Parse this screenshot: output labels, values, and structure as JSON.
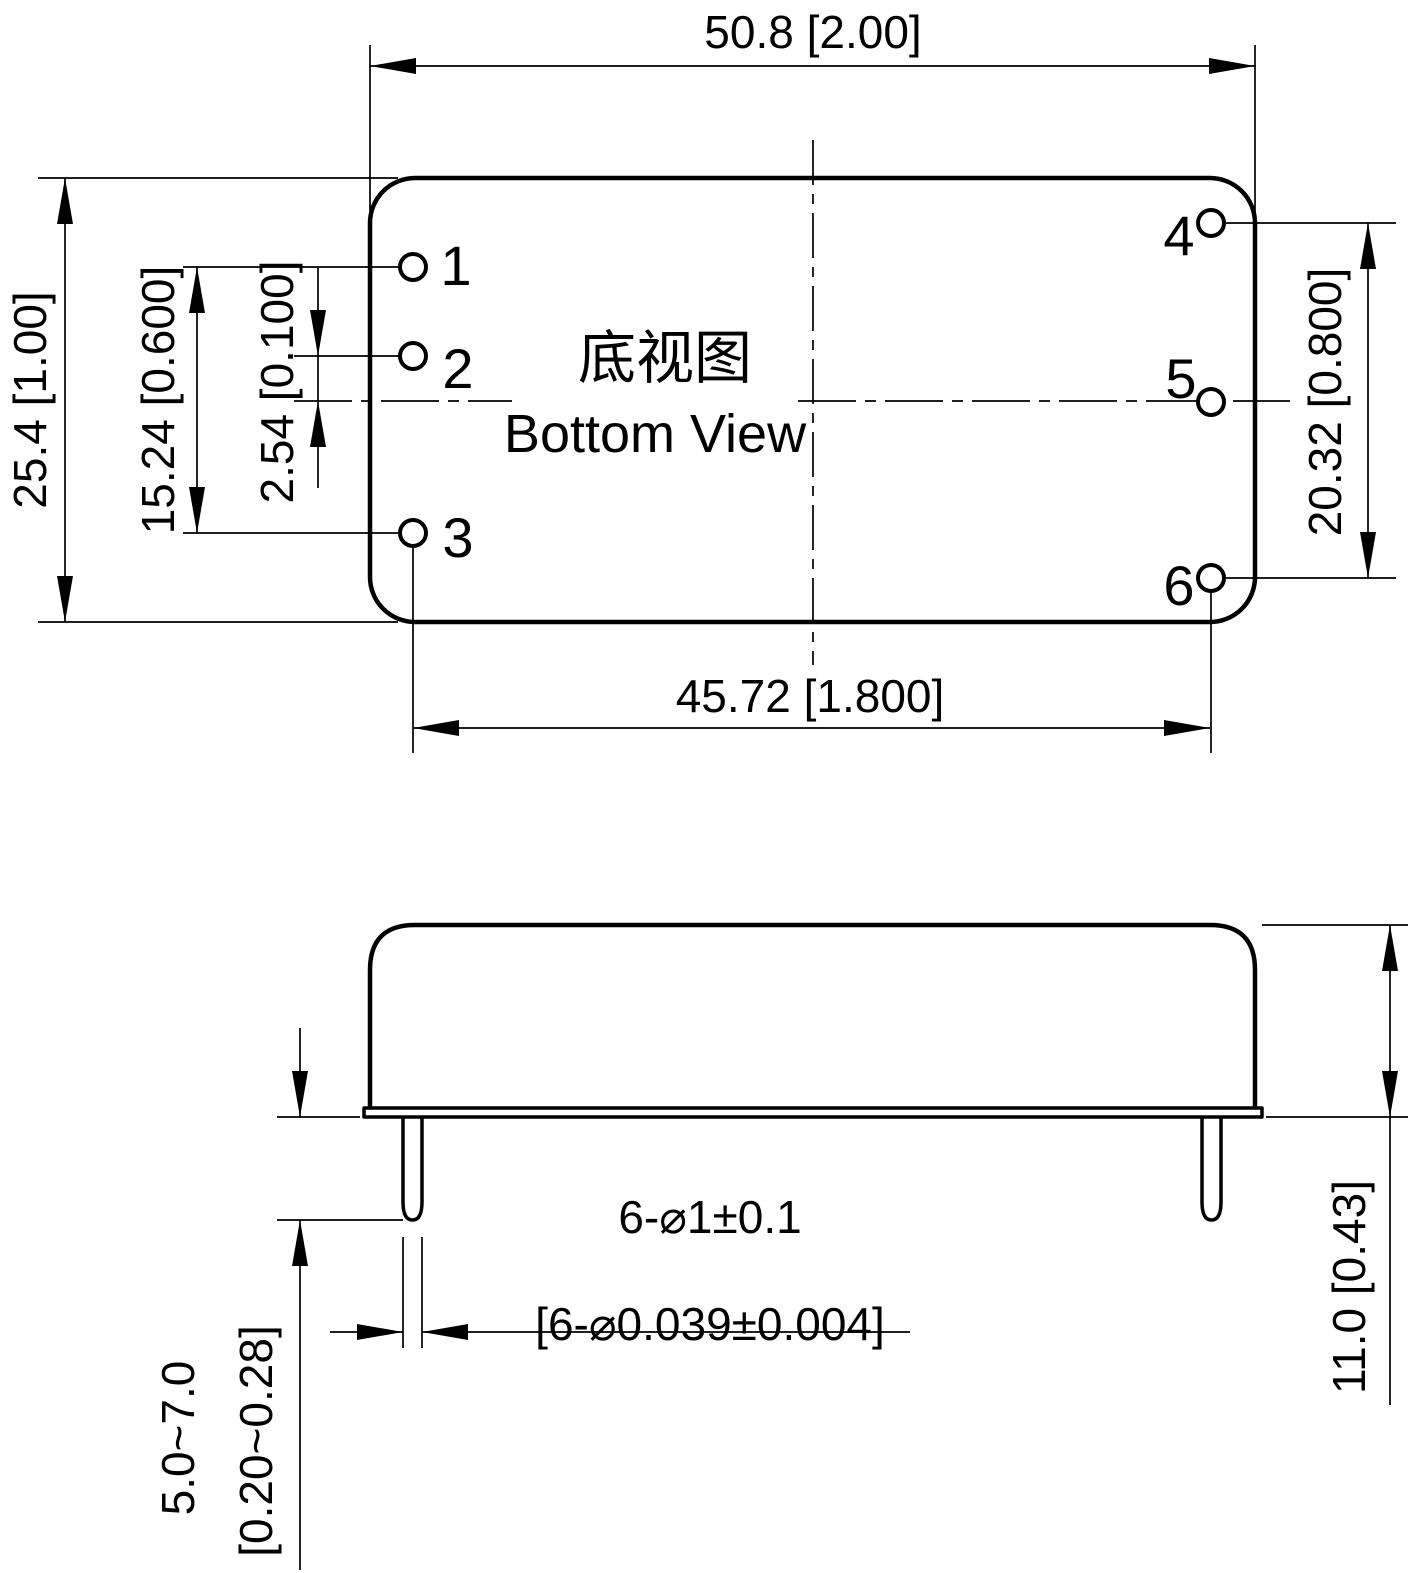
{
  "view_titles": {
    "zh": "底视图",
    "en": "Bottom View"
  },
  "pins": {
    "p1": "1",
    "p2": "2",
    "p3": "3",
    "p4": "4",
    "p5": "5",
    "p6": "6"
  },
  "dimensions": {
    "body_width": "50.8 [2.00]",
    "body_depth": "25.4 [1.00]",
    "pin1_to_pin3": "15.24 [0.600]",
    "pin2_to_centerline": "2.54 [0.100]",
    "pin3_to_pin6": "45.72 [1.800]",
    "pin4_to_pin6": "20.32 [0.800]",
    "case_height": "11.0 [0.43]",
    "pin_length_mm": "5.0~7.0",
    "pin_length_inch": "[0.20~0.28]",
    "pin_diameter_mm": "6-⌀1±0.1",
    "pin_diameter_inch": "[6-⌀0.039±0.004]"
  },
  "colors": {
    "line": "#000000",
    "background": "#ffffff"
  }
}
